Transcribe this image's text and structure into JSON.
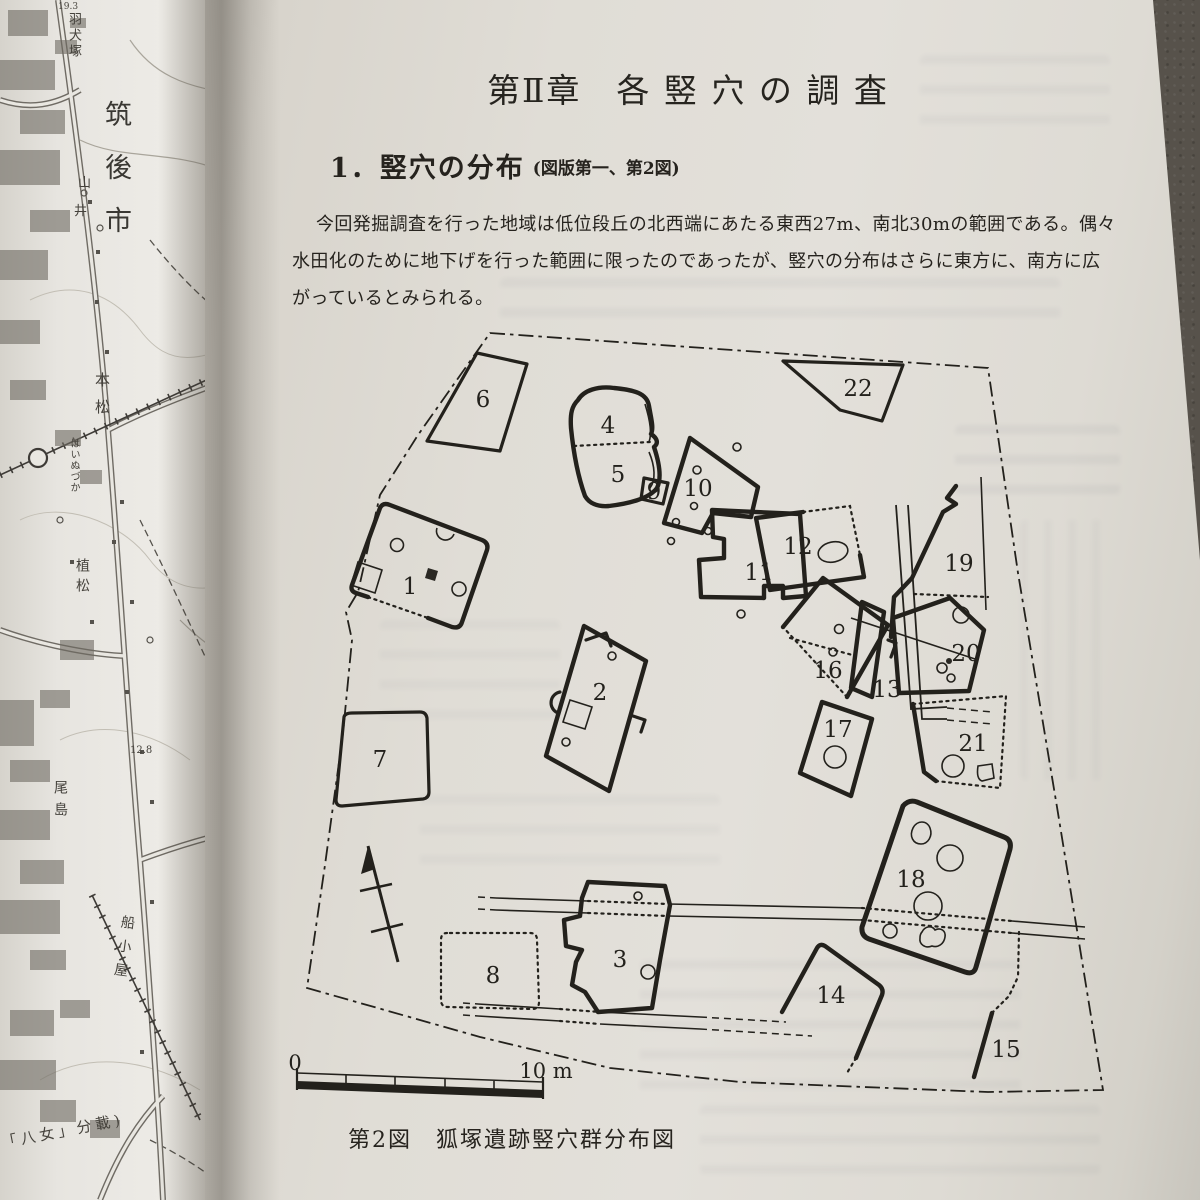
{
  "right_page": {
    "chapter_title": "第Ⅱ章　各 竪 穴 の 調 査",
    "section_heading": "1．竪穴の分布",
    "section_heading_note": "(図版第一、第2図)",
    "paragraph_lines": [
      "今回発掘調査を行った地域は低位段丘の北西端にあたる東西27m、南北30mの範囲である。偶々",
      "水田化のために地下げを行った範囲に限ったのであったが、竪穴の分布はさらに東方に、南方に広",
      "がっているとみられる。"
    ],
    "figure_caption": "第2図　狐塚遺跡竪穴群分布図",
    "scale_bar": {
      "start_label": "0",
      "end_label": "10 m"
    }
  },
  "site_plan": {
    "type": "excavation-area plan with numbered pit dwellings",
    "pits": [
      {
        "label": "1"
      },
      {
        "label": "2"
      },
      {
        "label": "3"
      },
      {
        "label": "4"
      },
      {
        "label": "5"
      },
      {
        "label": "6"
      },
      {
        "label": "7"
      },
      {
        "label": "8"
      },
      {
        "label": "9"
      },
      {
        "label": "10"
      },
      {
        "label": "11"
      },
      {
        "label": "12"
      },
      {
        "label": "13"
      },
      {
        "label": "14"
      },
      {
        "label": "15"
      },
      {
        "label": "16"
      },
      {
        "label": "17"
      },
      {
        "label": "18"
      },
      {
        "label": "19"
      },
      {
        "label": "20"
      },
      {
        "label": "21"
      },
      {
        "label": "22"
      }
    ]
  },
  "map_page": {
    "labels": {
      "hainuzuka": "羽犬塚",
      "chikugo_city": "筑後市",
      "yama": "山",
      "i": "井",
      "motomatsu": "本松",
      "station_kana": "はいぬづか",
      "uematsu": "植松",
      "elev_19_3": "19.3",
      "elev_12_8": "12.8",
      "ojima": "尾島",
      "funagoya": "船小屋",
      "inset_note": "「八女」分載)"
    }
  }
}
